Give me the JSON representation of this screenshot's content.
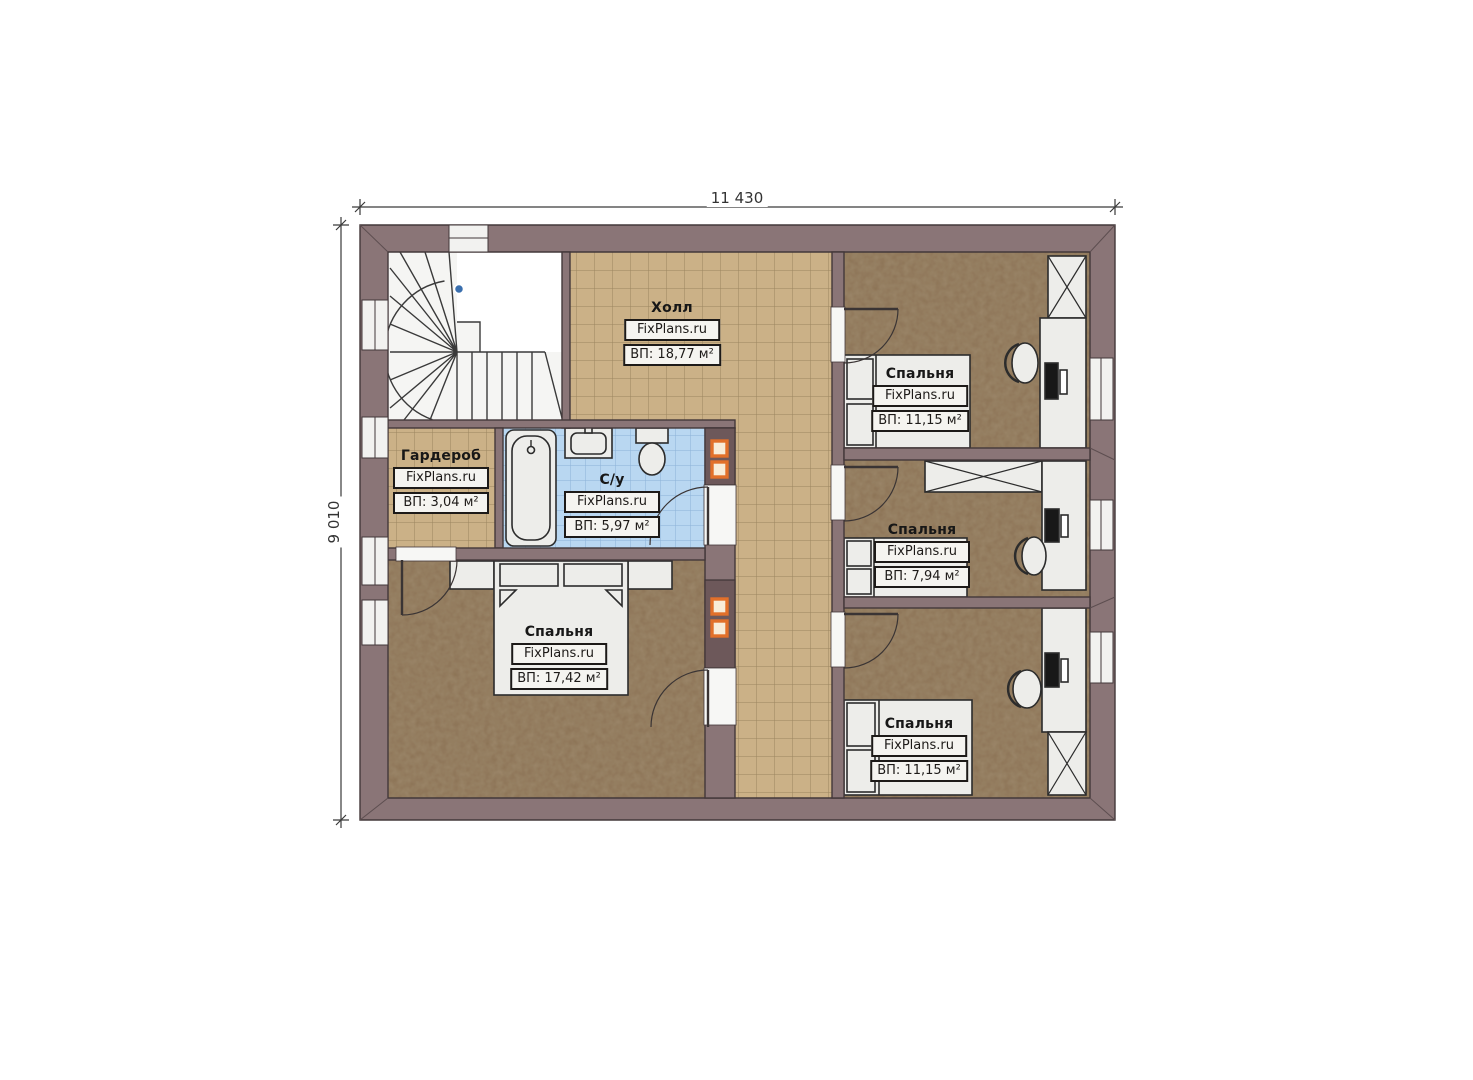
{
  "plan": {
    "type": "floor-plan",
    "floor_description": "Second floor plan with staircase, hall, bathroom, wardrobe and four bedrooms"
  },
  "dimensions": {
    "width_label": "11 430",
    "height_label": "9 010"
  },
  "brand": "FixPlans.ru",
  "rooms": {
    "hall": {
      "name": "Холл",
      "area": "ВП: 18,77 м²"
    },
    "wardrobe": {
      "name": "Гардероб",
      "area": "ВП: 3,04 м²"
    },
    "bathroom": {
      "name": "С/у",
      "area": "ВП: 5,97 м²"
    },
    "bedroom_master": {
      "name": "Спальня",
      "area": "ВП: 17,42 м²"
    },
    "bedroom_top": {
      "name": "Спальня",
      "area": "ВП: 11,15 м²"
    },
    "bedroom_middle": {
      "name": "Спальня",
      "area": "ВП: 7,94 м²"
    },
    "bedroom_bottom": {
      "name": "Спальня",
      "area": "ВП: 11,15 м²"
    }
  },
  "colors": {
    "wall": "#8a7577",
    "tile_floor": "#cbb187",
    "bathroom_tile": "#b9d7f1",
    "bedroom_floor": "#8b7254",
    "stair_floor": "#f4f4f2",
    "vent_accent": "#e2702a"
  }
}
